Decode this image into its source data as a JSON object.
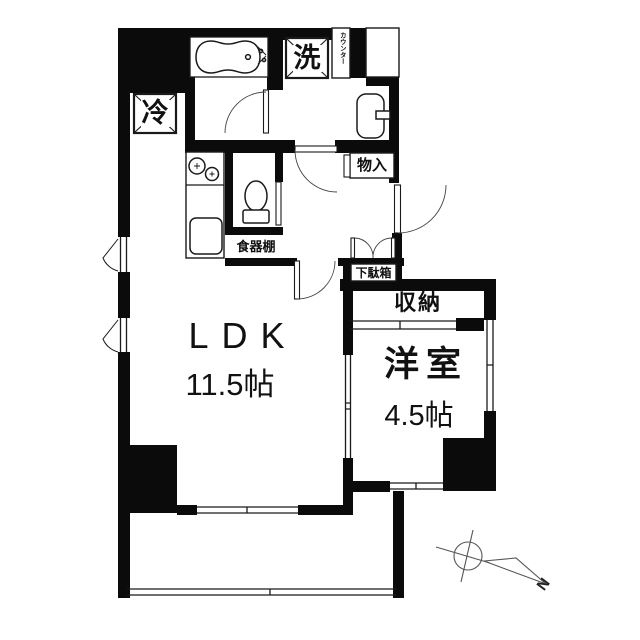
{
  "floorplan": {
    "rooms": {
      "ldk": {
        "name": "LDK",
        "size": "11.5帖"
      },
      "western_room": {
        "name": "洋室",
        "size": "4.5帖"
      },
      "closet": {
        "label": "収納"
      },
      "hall_storage": {
        "label": "物入"
      },
      "shoe_cabinet": {
        "label": "下駄箱"
      },
      "dish_shelf": {
        "label": "食器棚"
      }
    },
    "fixtures": {
      "washing_machine": {
        "label": "洗"
      },
      "refrigerator": {
        "label": "冷"
      },
      "counter": {
        "label": "カウンター"
      }
    },
    "compass": {
      "north_label": "N"
    },
    "colors": {
      "wall": "#0b0b0b",
      "line": "#1a1a1a",
      "background": "#ffffff",
      "compass_line": "#555555"
    }
  }
}
